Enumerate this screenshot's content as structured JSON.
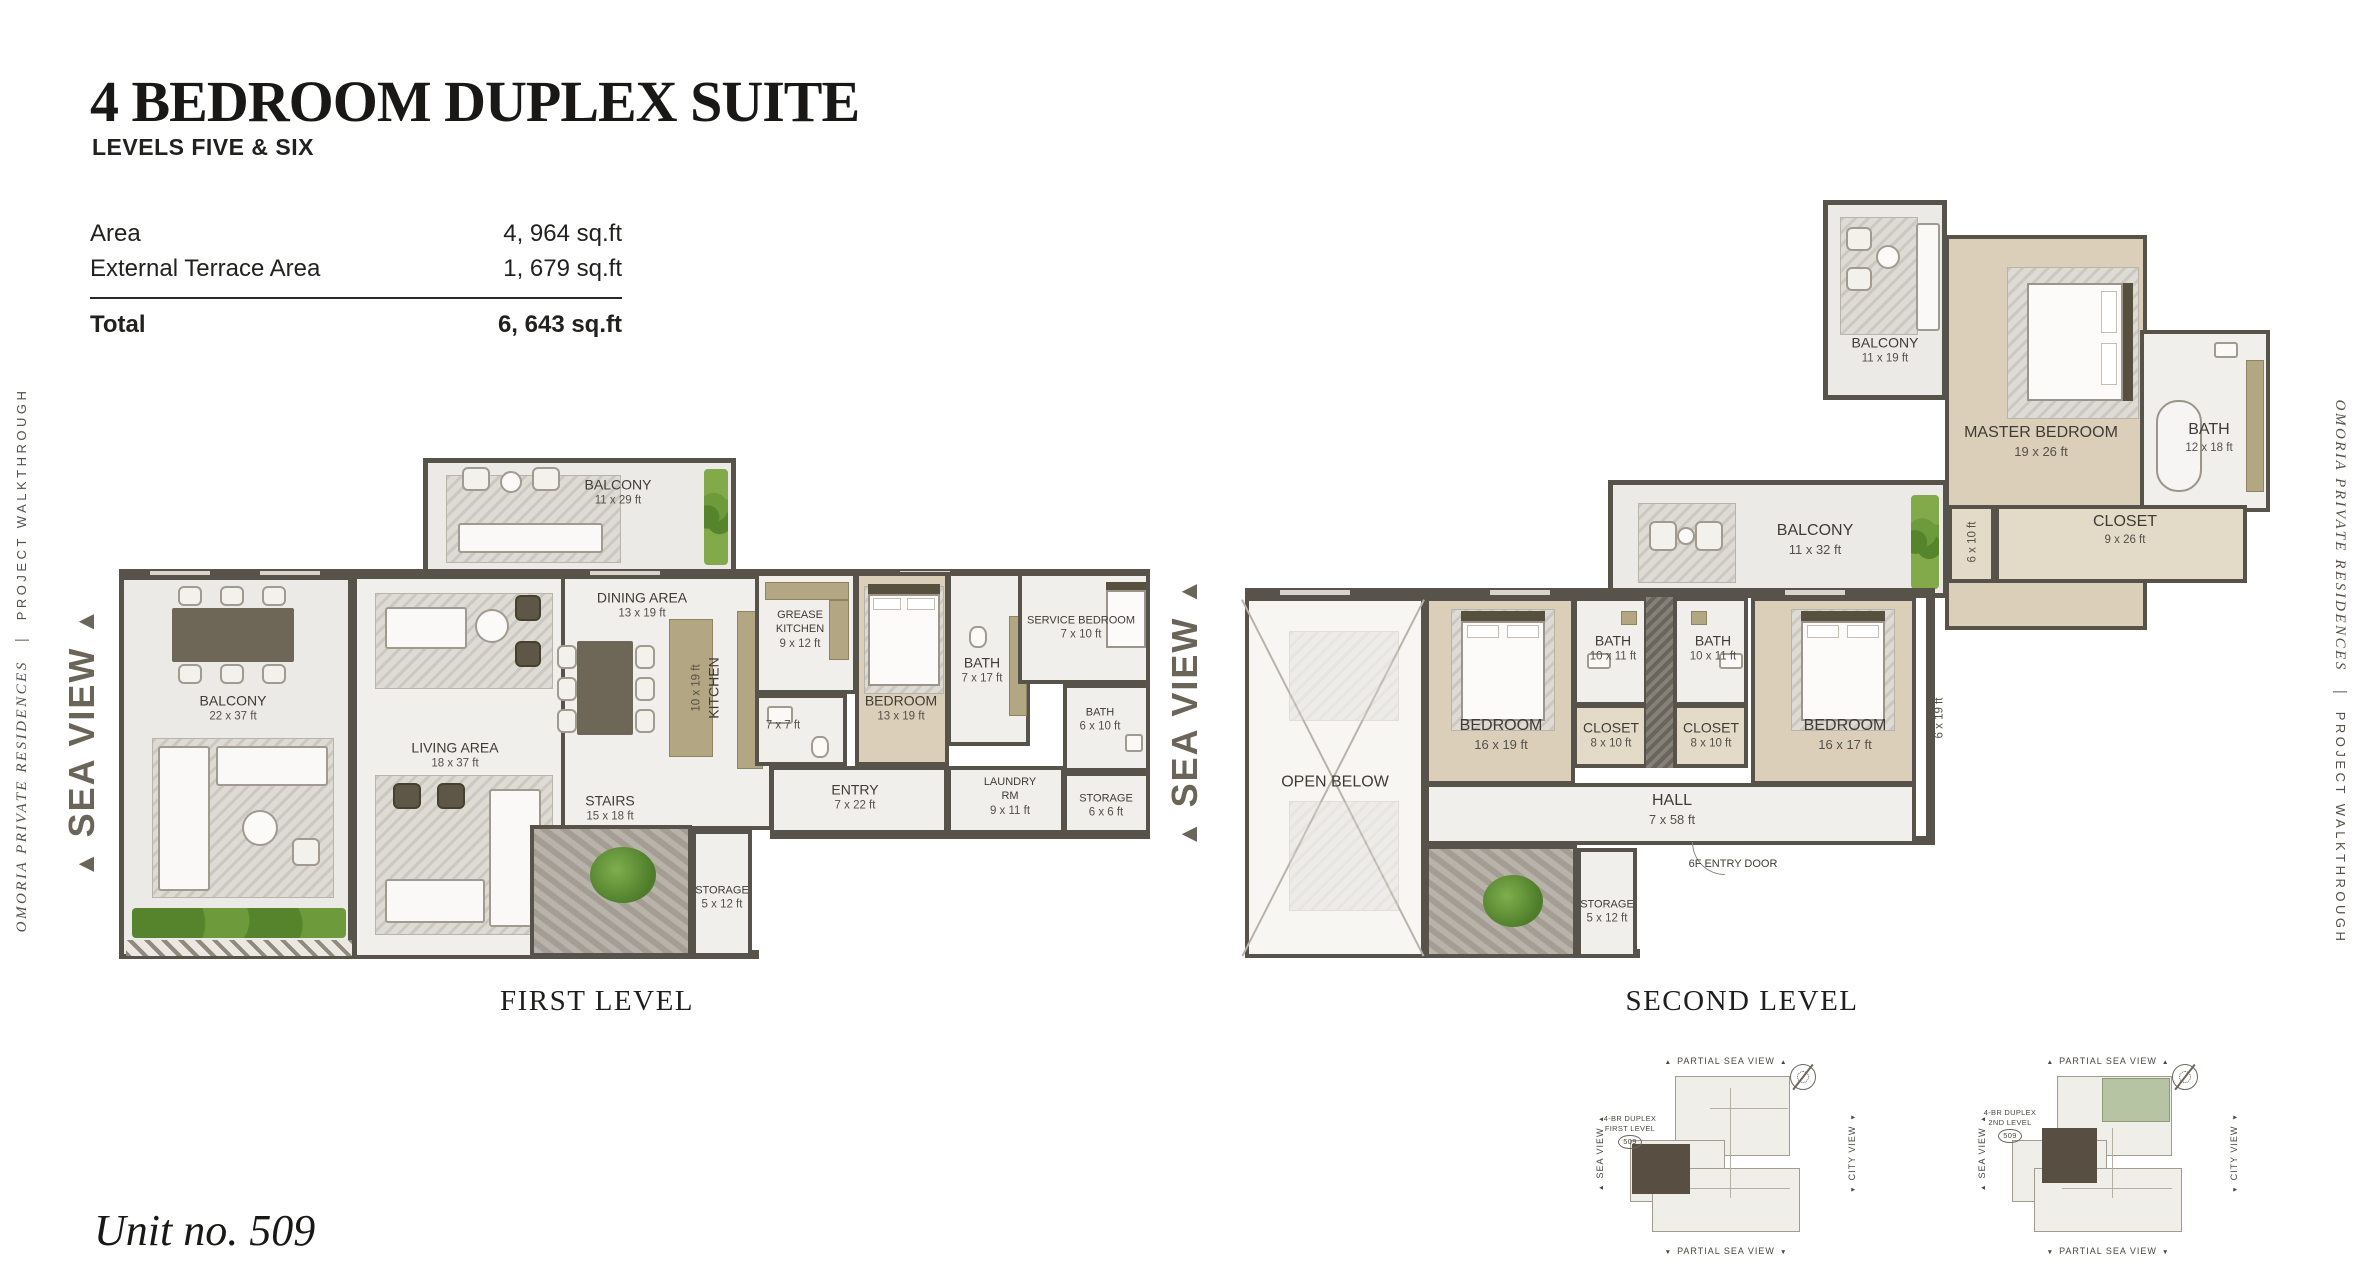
{
  "page": {
    "title": "4 BEDROOM DUPLEX SUITE",
    "subtitle": "LEVELS FIVE & SIX",
    "unit_number": "Unit no. 509",
    "brand_name": "OMORIA PRIVATE RESIDENCES",
    "brand_divider": "|",
    "brand_tagline": "PROJECT WALKTHROUGH",
    "sea_view": "SEA VIEW"
  },
  "area_table": {
    "rows": [
      {
        "label": "Area",
        "value": "4, 964 sq.ft"
      },
      {
        "label": "External Terrace Area",
        "value": "1, 679 sq.ft"
      }
    ],
    "total": {
      "label": "Total",
      "value": "6, 643 sq.ft"
    }
  },
  "first_level": {
    "caption": "FIRST LEVEL",
    "rooms": [
      {
        "name": "BALCONY",
        "size": "11 x 29 ft"
      },
      {
        "name": "BALCONY",
        "size": "22 x 37 ft"
      },
      {
        "name": "LIVING AREA",
        "size": "18 x 37 ft"
      },
      {
        "name": "DINING AREA",
        "size": "13 x 19 ft"
      },
      {
        "name": "KITCHEN",
        "size": "10 x 19 ft"
      },
      {
        "name": "GREASE KITCHEN",
        "size": "9 x 12 ft"
      },
      {
        "name": "",
        "size": "7 x 7 ft"
      },
      {
        "name": "BEDROOM",
        "size": "13 x 19 ft"
      },
      {
        "name": "BATH",
        "size": "7 x 17 ft"
      },
      {
        "name": "SERVICE BEDROOM",
        "size": "7 x 10 ft"
      },
      {
        "name": "BATH",
        "size": "6 x 10 ft"
      },
      {
        "name": "ENTRY",
        "size": "7 x 22 ft"
      },
      {
        "name": "LAUNDRY RM",
        "size": "9 x 11 ft"
      },
      {
        "name": "STORAGE",
        "size": "6 x 6 ft"
      },
      {
        "name": "STAIRS",
        "size": "15 x 18 ft"
      },
      {
        "name": "STORAGE",
        "size": "5 x 12 ft"
      }
    ]
  },
  "second_level": {
    "caption": "SECOND LEVEL",
    "rooms": [
      {
        "name": "BALCONY",
        "size": "11 x 19 ft"
      },
      {
        "name": "MASTER BEDROOM",
        "size": "19 x 26 ft"
      },
      {
        "name": "BATH",
        "size": "12 x 18 ft"
      },
      {
        "name": "CLOSET",
        "size": "9 x 26 ft"
      },
      {
        "name": "BALCONY",
        "size": "11 x 32 ft"
      },
      {
        "name": "",
        "size": "6 x 10 ft"
      },
      {
        "name": "OPEN BELOW",
        "size": ""
      },
      {
        "name": "BEDROOM",
        "size": "16 x 19 ft"
      },
      {
        "name": "BATH",
        "size": "10 x 11 ft"
      },
      {
        "name": "CLOSET",
        "size": "8 x 10 ft"
      },
      {
        "name": "BATH",
        "size": "10 x 11 ft"
      },
      {
        "name": "CLOSET",
        "size": "8 x 10 ft"
      },
      {
        "name": "BEDROOM",
        "size": "16 x 17 ft"
      },
      {
        "name": "HALL",
        "size": "7 x 58 ft"
      },
      {
        "name": "6F ENTRY DOOR",
        "size": ""
      },
      {
        "name": "STORAGE",
        "size": "5 x 12 ft"
      },
      {
        "name": "",
        "size": "6 x 19 ft"
      }
    ]
  },
  "key_plans": {
    "partial_sea_view": "PARTIAL SEA VIEW",
    "sea_view": "SEA VIEW",
    "city_view": "CITY VIEW",
    "plans": [
      {
        "line1": "4-BR DUPLEX",
        "line2": "FIRST LEVEL",
        "unit": "509"
      },
      {
        "line1": "4-BR DUPLEX",
        "line2": "2ND LEVEL",
        "unit": "509"
      }
    ]
  },
  "colors": {
    "wall": "#57524a",
    "accent_green": "#76a13d",
    "sea_view_text": "#6b6459"
  }
}
